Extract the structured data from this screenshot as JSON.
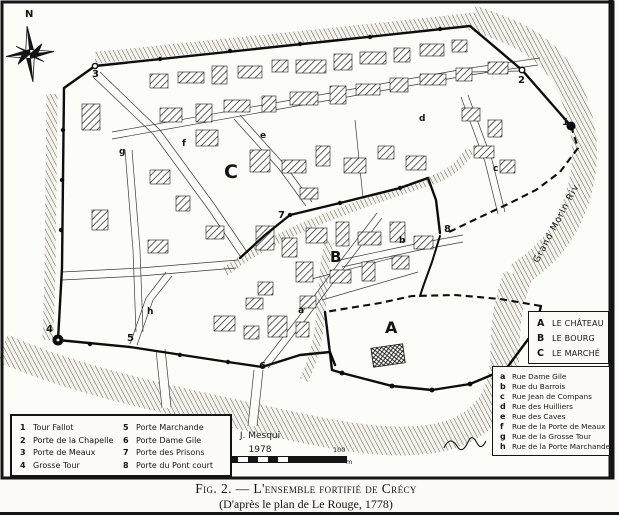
{
  "figure": {
    "caption_line1": "Fig. 2. — L'ensemble fortifié de Crécy",
    "caption_line2": "(D'après le plan de Le Rouge, 1778)"
  },
  "map": {
    "compass": "N",
    "river_label": "Grand Morin Riv.",
    "credit_name": "J. Mesqui",
    "credit_year": "1978",
    "scale_start": "0",
    "scale_end": "100",
    "scale_unit": "m",
    "areas": [
      "A",
      "B",
      "C"
    ],
    "gates": [
      "1",
      "2",
      "3",
      "4",
      "5",
      "6",
      "7",
      "8"
    ],
    "streets": [
      "a",
      "b",
      "c",
      "d",
      "e",
      "f",
      "g",
      "h"
    ]
  },
  "legend_gates": {
    "items": [
      {
        "num": "1",
        "label": "Tour Fallot"
      },
      {
        "num": "2",
        "label": "Porte de la Chapelle"
      },
      {
        "num": "3",
        "label": "Porte de Meaux"
      },
      {
        "num": "4",
        "label": "Grosse Tour"
      },
      {
        "num": "5",
        "label": "Porte Marchande"
      },
      {
        "num": "6",
        "label": "Porte Dame Gile"
      },
      {
        "num": "7",
        "label": "Porte des Prisons"
      },
      {
        "num": "8",
        "label": "Porte du Pont court"
      }
    ]
  },
  "legend_areas": {
    "items": [
      {
        "letter": "A",
        "label": "LE CHÂTEAU"
      },
      {
        "letter": "B",
        "label": "LE BOURG"
      },
      {
        "letter": "C",
        "label": "LE MARCHÉ"
      }
    ]
  },
  "legend_streets": {
    "items": [
      {
        "letter": "a",
        "label": "Rue Dame Gile"
      },
      {
        "letter": "b",
        "label": "Rue du Barrois"
      },
      {
        "letter": "c",
        "label": "Rue Jean de Compans"
      },
      {
        "letter": "d",
        "label": "Rue des Huilliers"
      },
      {
        "letter": "e",
        "label": "Rue des Caves"
      },
      {
        "letter": "f",
        "label": "Rue de la Porte de Meaux"
      },
      {
        "letter": "g",
        "label": "Rue de la Grosse Tour"
      },
      {
        "letter": "h",
        "label": "Rue de la Porte Marchande"
      }
    ]
  },
  "colors": {
    "ink": "#141414",
    "paper": "#fbfaf6"
  }
}
